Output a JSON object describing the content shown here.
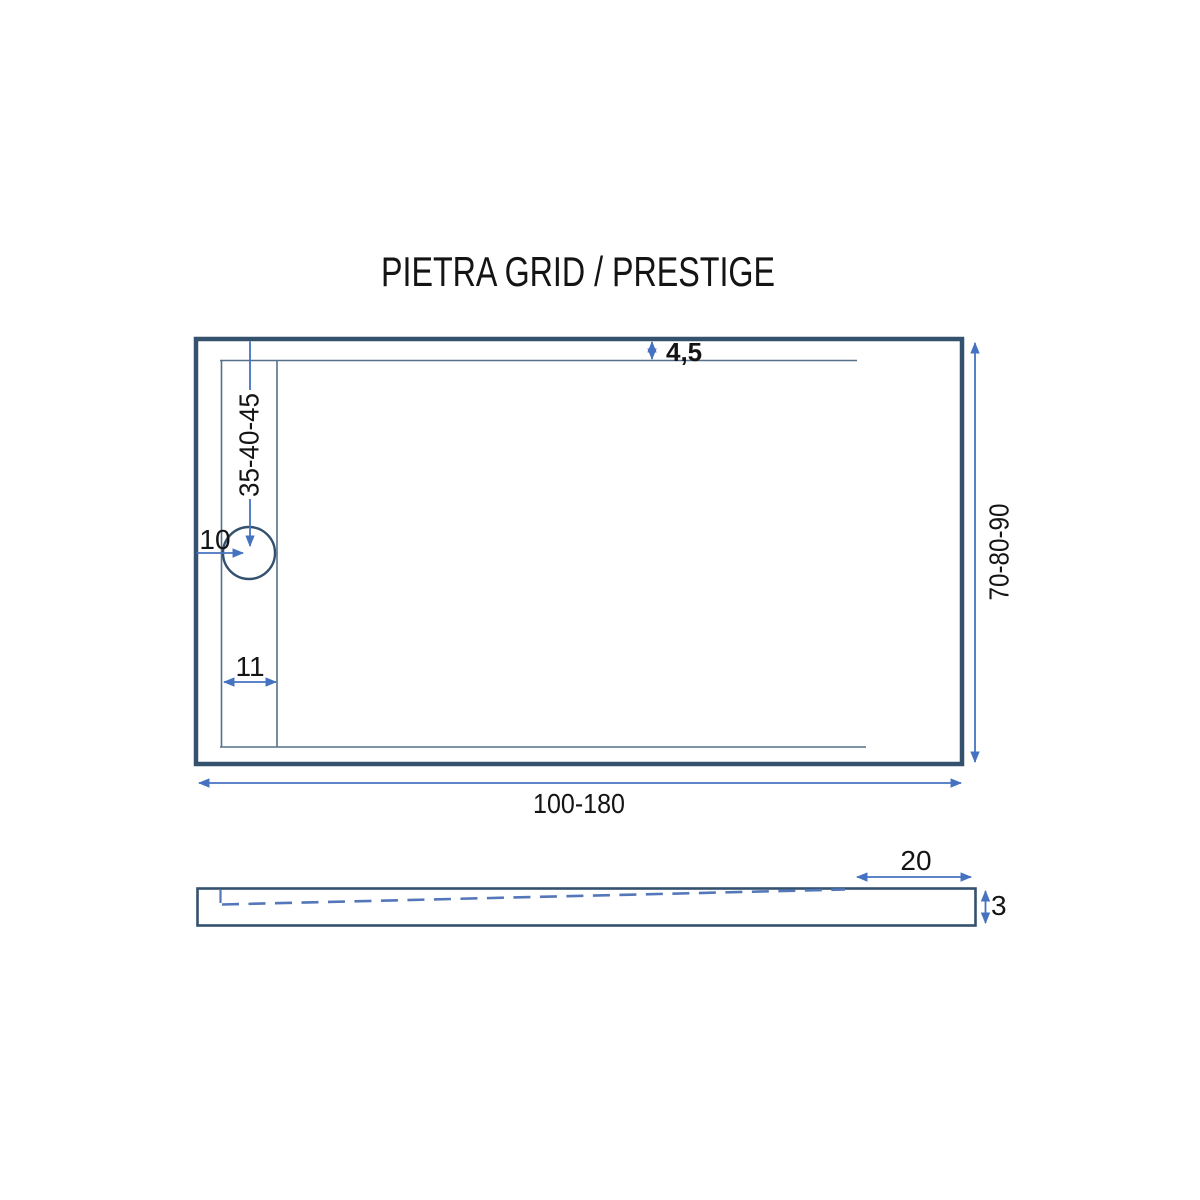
{
  "title": "PIETRA GRID / PRESTIGE",
  "colors": {
    "outline": "#34526e",
    "inner_line": "#54708a",
    "dimension": "#4673c1",
    "dash": "#5377b8",
    "label": "#141414"
  },
  "plan": {
    "labels": {
      "top_edge_gap": "4,5",
      "drain_vertical_offset": "35-40-45",
      "drain_hole": "10",
      "channel_width": "11",
      "height_range": "70-80-90",
      "width_range": "100-180"
    }
  },
  "side": {
    "labels": {
      "flat_end_length": "20",
      "edge_thickness": "3"
    }
  }
}
